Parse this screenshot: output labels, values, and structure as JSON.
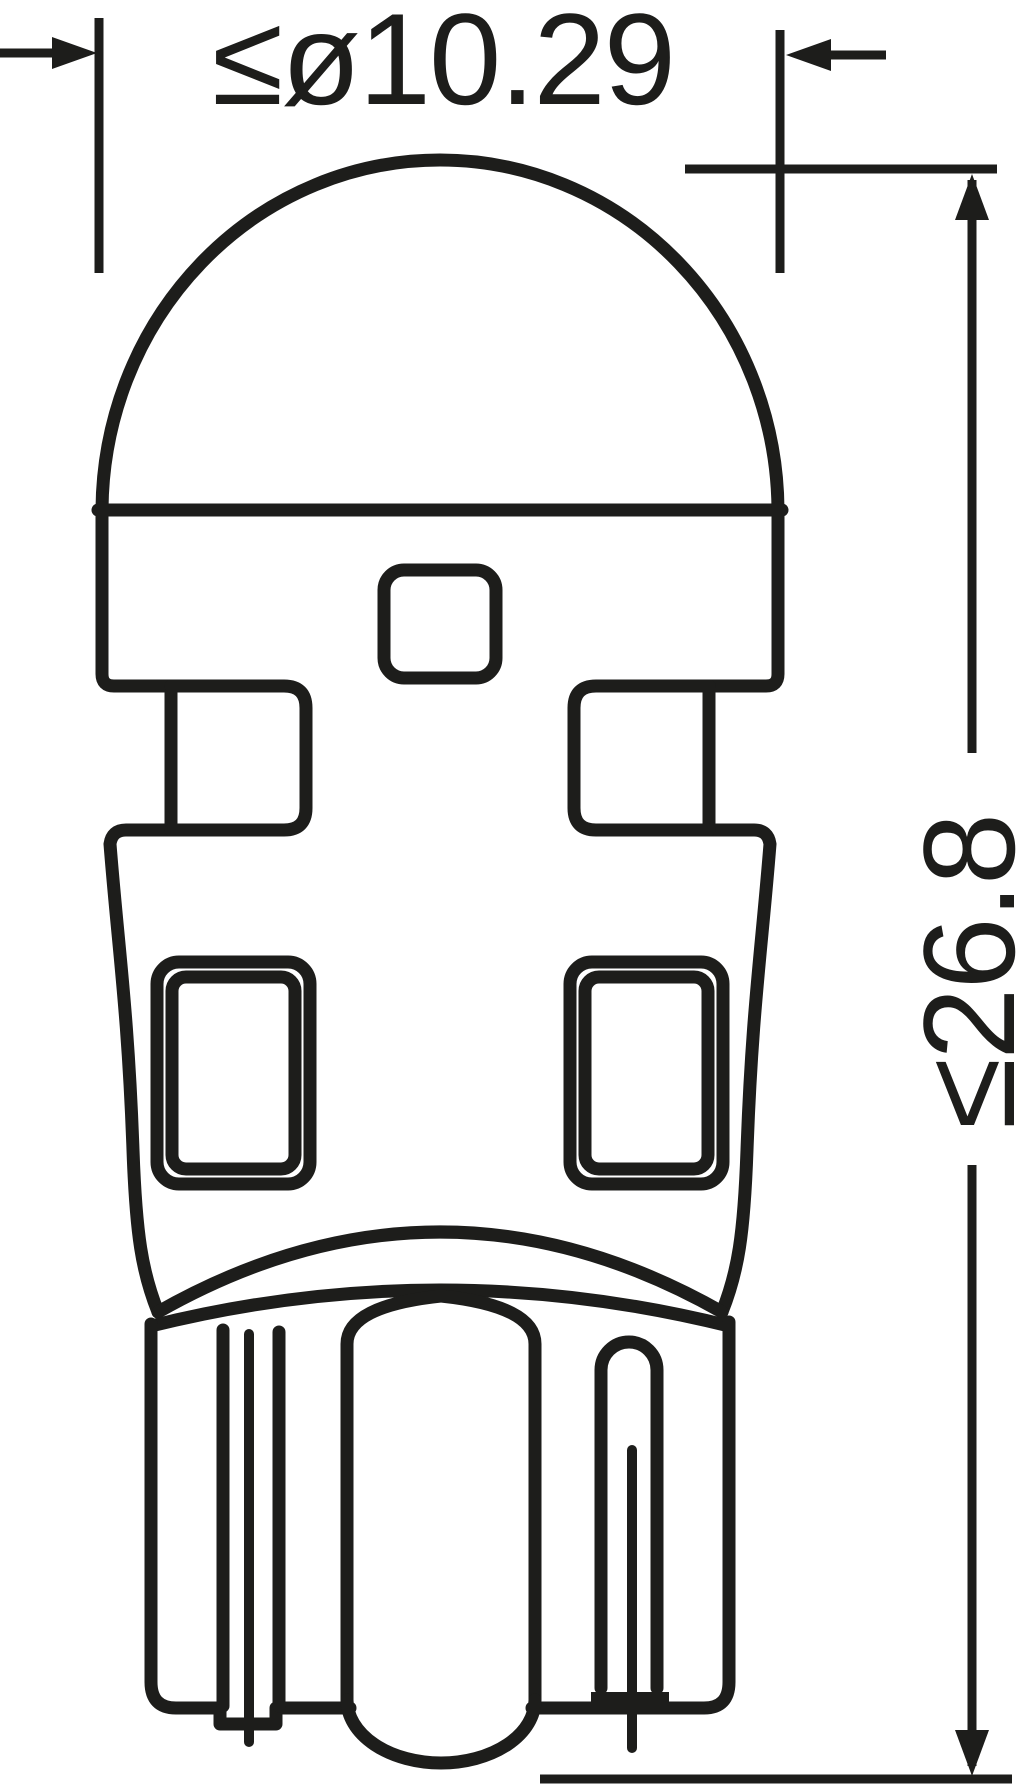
{
  "drawing": {
    "kind": "technical-dimension-drawing",
    "subject": "wedge-base LED bulb, side elevation",
    "dimensions": {
      "diameter": {
        "label": "≤ø10.29"
      },
      "length": {
        "label": "≤26.8"
      }
    },
    "colors": {
      "ink": "#1d1d1b",
      "background": "#ffffff"
    }
  }
}
